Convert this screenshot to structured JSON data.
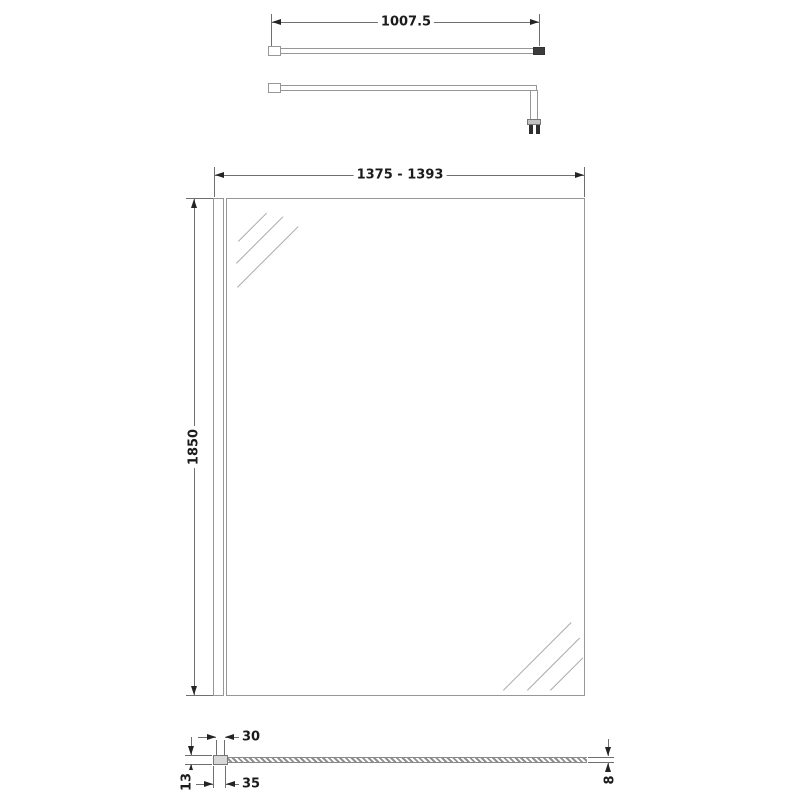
{
  "drawing": {
    "type": "wetroom-screen-technical-drawing",
    "views": {
      "support_bar_top": {
        "length_label": "1007.5"
      },
      "front": {
        "width_label": "1375 - 1393",
        "height_label": "1850"
      },
      "plan": {
        "offset_label": "30",
        "profile_width_label": "35",
        "profile_depth_label": "13",
        "glass_thickness_label": "8"
      }
    },
    "colors": {
      "background": "#ffffff",
      "outline": "#979797",
      "dimension_lines": "#6f6f6f",
      "arrows": "#242424",
      "text": "#1b1b1b"
    }
  }
}
